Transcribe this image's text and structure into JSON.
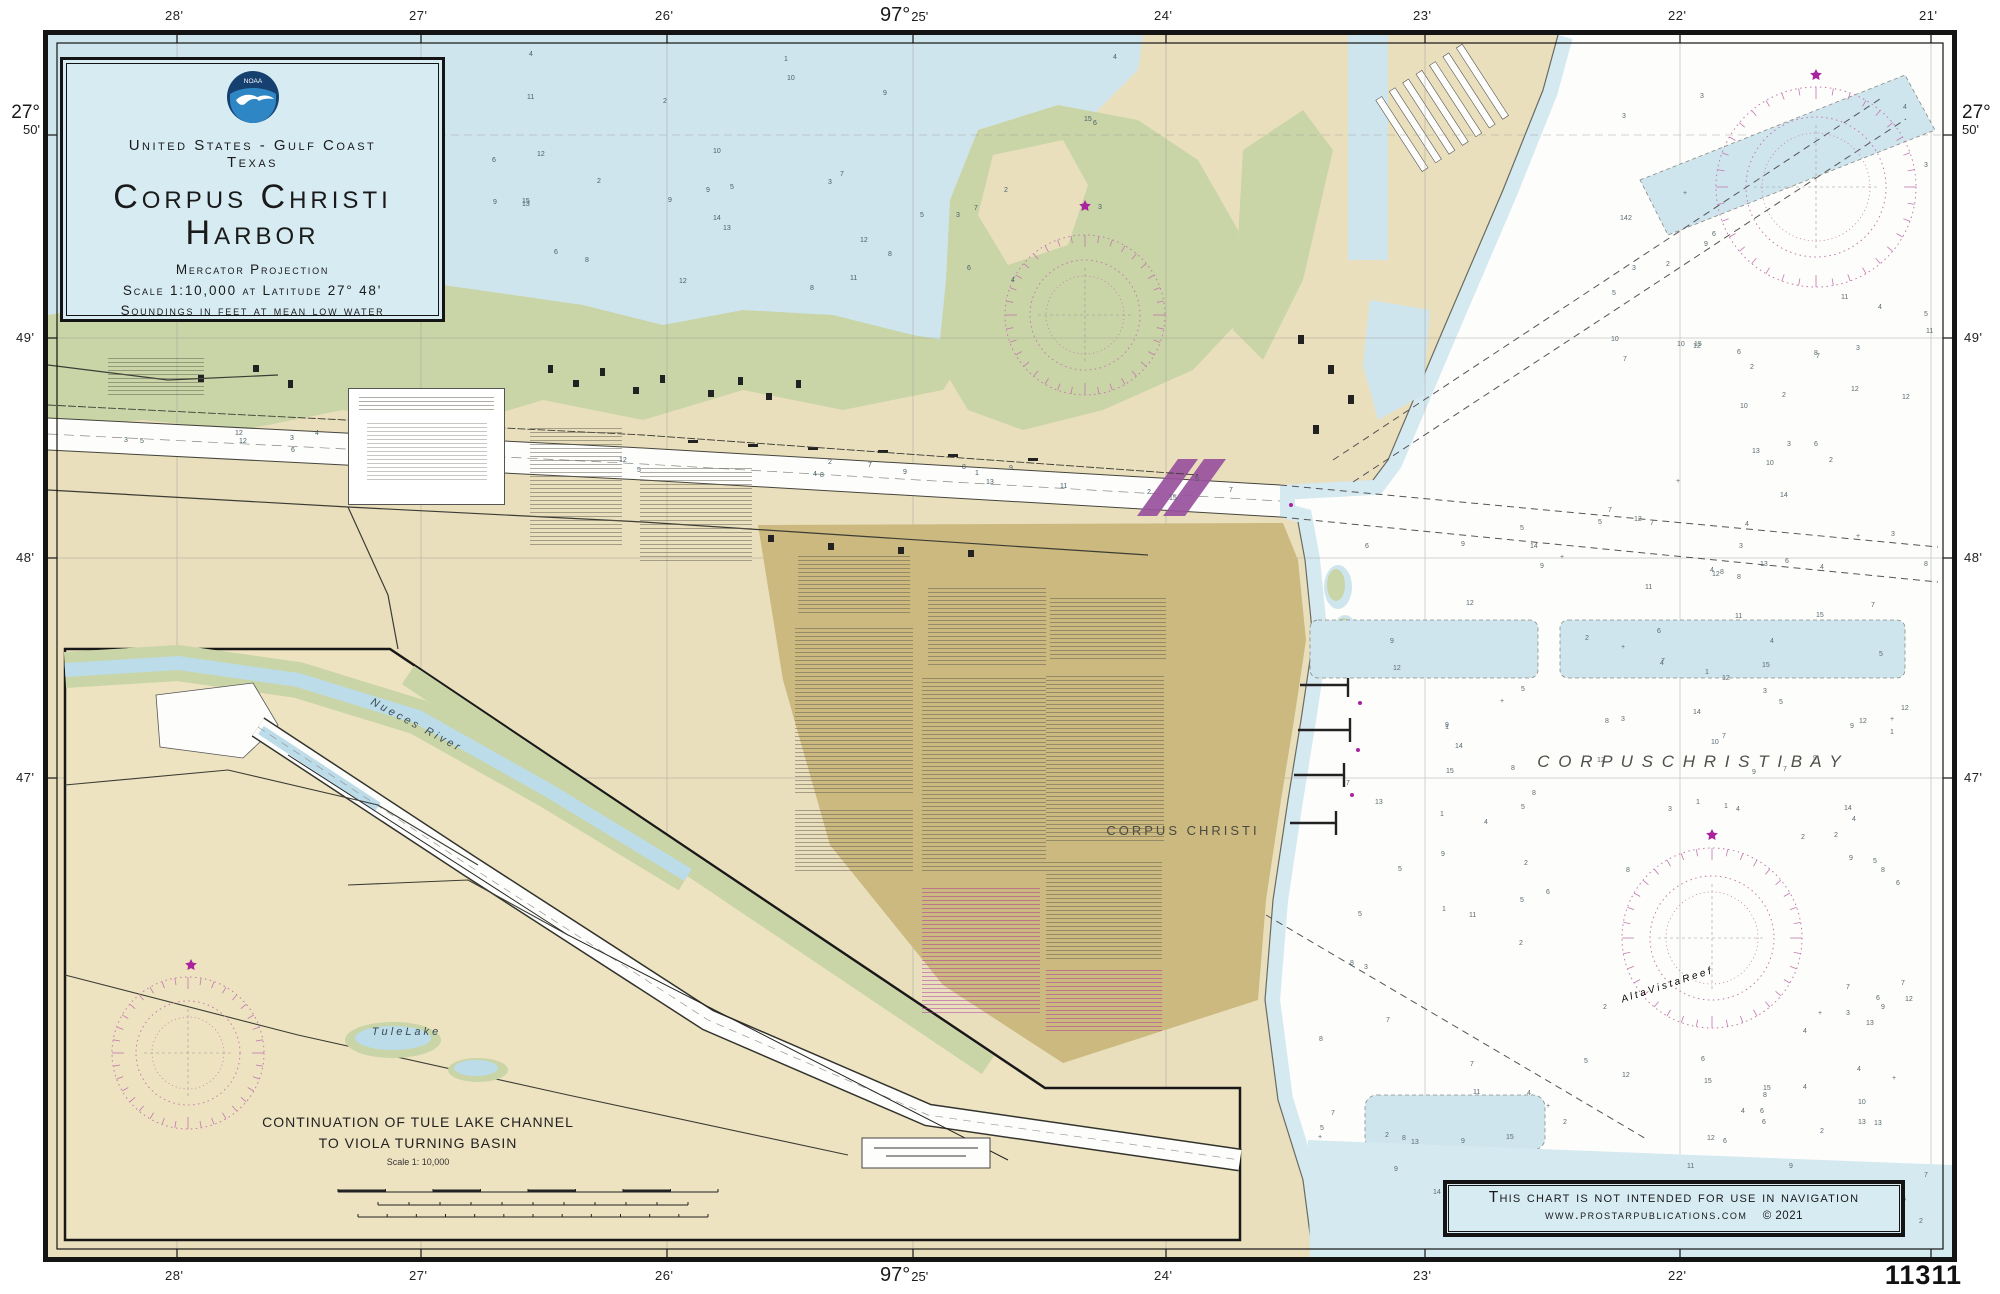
{
  "chart_number": "11311",
  "title_block": {
    "logo": "NOAA",
    "region": "United States - Gulf Coast",
    "state": "Texas",
    "title1": "Corpus Christi",
    "title2": "Harbor",
    "projection": "Mercator Projection",
    "scale": "Scale 1:10,000 at Latitude 27° 48'",
    "soundings": "Soundings in feet at mean low water"
  },
  "warning": {
    "line1": "This chart is not intended for use in navigation",
    "website": "www.prostarpublications.com",
    "copyright": "© 2021"
  },
  "places": {
    "bay": "C O R P U S   C H R I S T I   B A Y",
    "city": "CORPUS CHRISTI",
    "reef": "A l t a   V i s t a   R e e f",
    "tule_lake": "T u l e   L a k e",
    "nueces_river": "Nueces River"
  },
  "inset": {
    "line1": "CONTINUATION OF TULE LAKE CHANNEL",
    "line2": "TO VIOLA TURNING BASIN",
    "scale": "Scale 1: 10,000"
  },
  "graticule": {
    "deg97": "97°",
    "deg27": "27°",
    "m28": "28'",
    "m27": "27'",
    "m26": "26'",
    "m25": "25'",
    "m24": "24'",
    "m23": "23'",
    "m22": "22'",
    "m21": "21'",
    "m50": "50'",
    "m49": "49'",
    "m48": "48'",
    "m47": "47'"
  },
  "soundings": {
    "values": [
      3,
      2,
      5,
      4,
      7,
      6,
      11,
      9,
      12,
      8,
      10,
      13,
      2,
      15,
      4,
      6,
      3,
      9,
      5,
      12,
      7,
      14,
      1,
      8
    ]
  },
  "colors": {
    "water": "#cfe5ee",
    "water_fringe": "#d5e9f1",
    "land": "#eadfbd",
    "inset_land": "#eee3c1",
    "marsh": "#c9d5a7",
    "city_area": "#cbb97f",
    "rose": "#c478ae",
    "highlight": "#99519d",
    "box_bg": "#d7ebf3",
    "accent": "#a8239d"
  }
}
